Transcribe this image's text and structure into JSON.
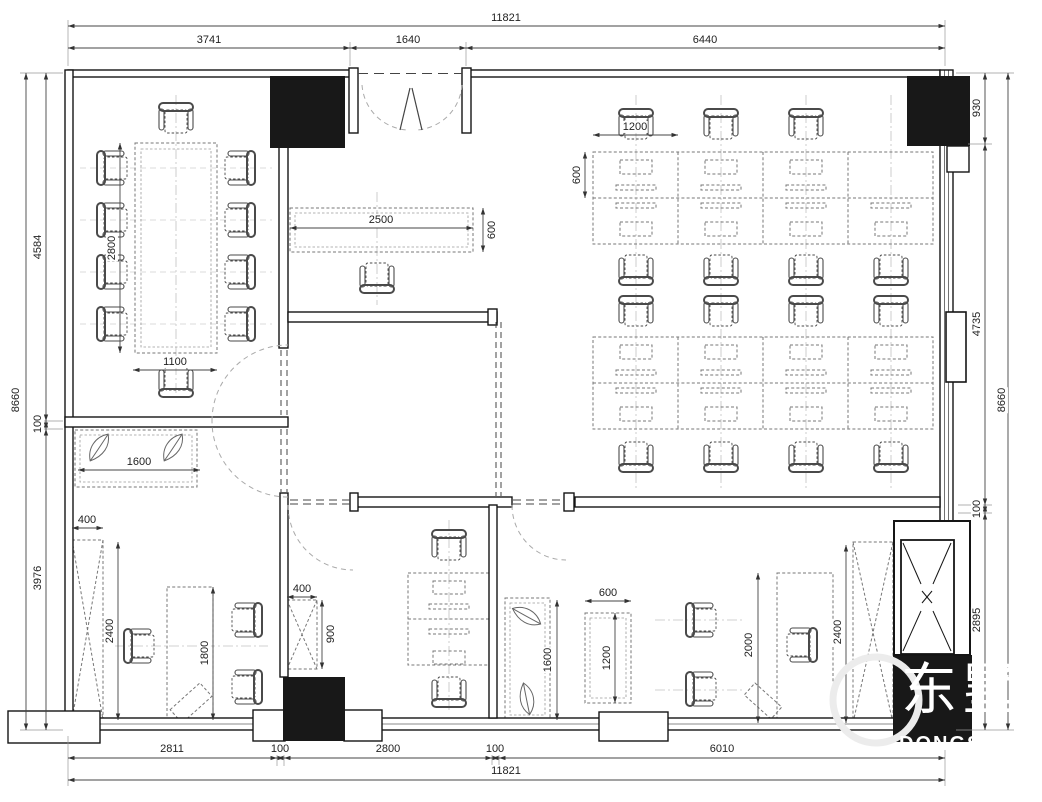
{
  "drawing": {
    "type": "office floor plan",
    "unit": "mm"
  },
  "dims": {
    "top": {
      "overall": "11821",
      "seg": [
        "3741",
        "1640",
        "6440"
      ]
    },
    "bottom": {
      "overall": "11821",
      "seg": [
        "2811",
        "100",
        "2800",
        "100",
        "6010"
      ]
    },
    "left": {
      "overall": "8660",
      "seg": [
        "4584",
        "100",
        "3976"
      ]
    },
    "right": {
      "overall": "8660",
      "seg": [
        "930",
        "4735",
        "100",
        "2895"
      ]
    },
    "conference": {
      "table_len": "2800",
      "table_wid": "1100"
    },
    "reception": {
      "counter_len": "2500",
      "counter_dep": "600"
    },
    "open_office": {
      "desk_wid": "1200",
      "desk_dep": "600"
    },
    "office_left": {
      "sideboard": "1600",
      "cab_wid": "400",
      "cab_len": "2400",
      "desk": "1800"
    },
    "office_mid": {
      "cab_wid": "400",
      "cab_len": "900"
    },
    "office_right": {
      "sideboard": "1600",
      "table_wid": "600",
      "table_len": "1200",
      "desk": "2000",
      "cab_len": "2400"
    }
  },
  "watermark": {
    "cjk": "东墅",
    "latin": "DONGSH"
  }
}
